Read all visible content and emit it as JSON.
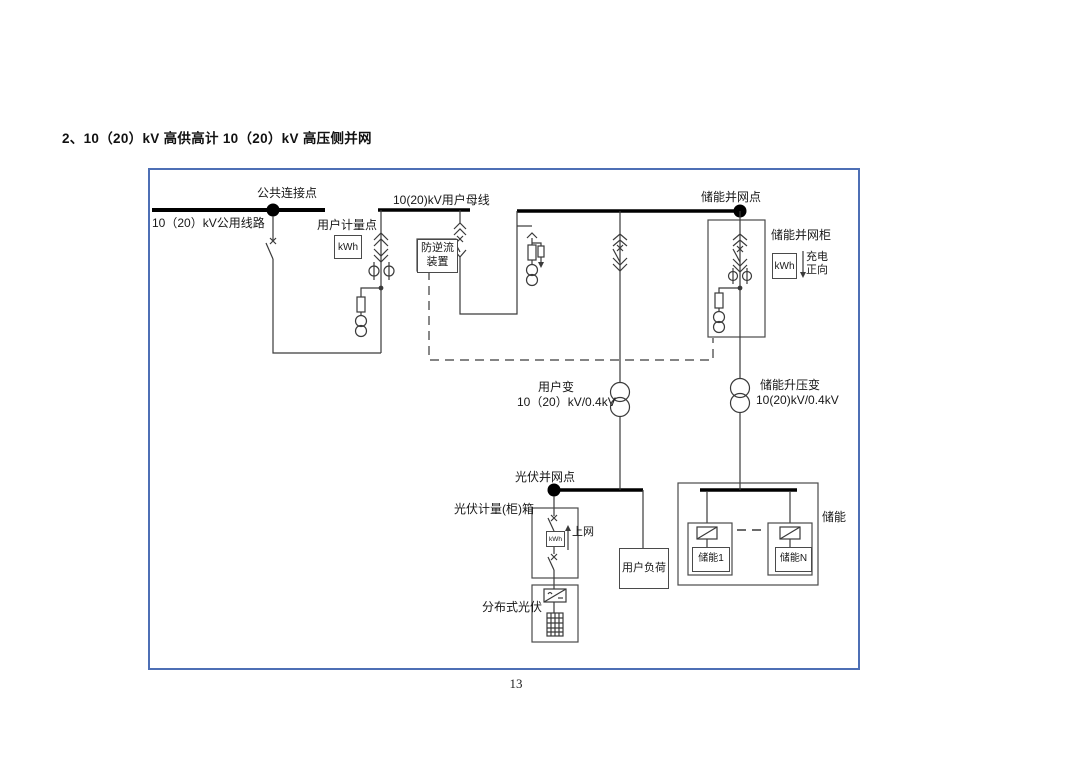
{
  "page": {
    "title": "2、10（20）kV 高供高计 10（20）kV 高压侧并网",
    "page_number": "13"
  },
  "diagram": {
    "colors": {
      "frame_border": "#4d6fb5",
      "line": "#3a3a3a",
      "busbar": "#000000",
      "box_border": "#4a4a4a"
    },
    "labels": {
      "public_connection_point": "公共连接点",
      "public_line": "10（20）kV公用线路",
      "user_metering_point": "用户计量点",
      "user_busbar": "10(20)kV用户母线",
      "anti_backflow_line1": "防逆流",
      "anti_backflow_line2": "装置",
      "storage_poc": "储能并网点",
      "storage_cabinet": "储能并网柜",
      "charge_dir_line1": "充电",
      "charge_dir_line2": "正向",
      "user_transformer_name": "用户变",
      "user_transformer_ratio": "10（20）kV/0.4kV",
      "storage_transformer_name": "储能升压变",
      "storage_transformer_ratio": "10(20)kV/0.4kV",
      "pv_poc": "光伏并网点",
      "pv_metering_box": "光伏计量(柜)箱",
      "to_grid": "上网",
      "user_load": "用户负荷",
      "distributed_pv": "分布式光伏",
      "storage_group": "储能",
      "storage_unit_1": "储能1",
      "storage_unit_n": "储能N"
    },
    "meters": {
      "user_meter": "kWh",
      "storage_meter": "kWh",
      "pv_meter": "kWh"
    }
  }
}
